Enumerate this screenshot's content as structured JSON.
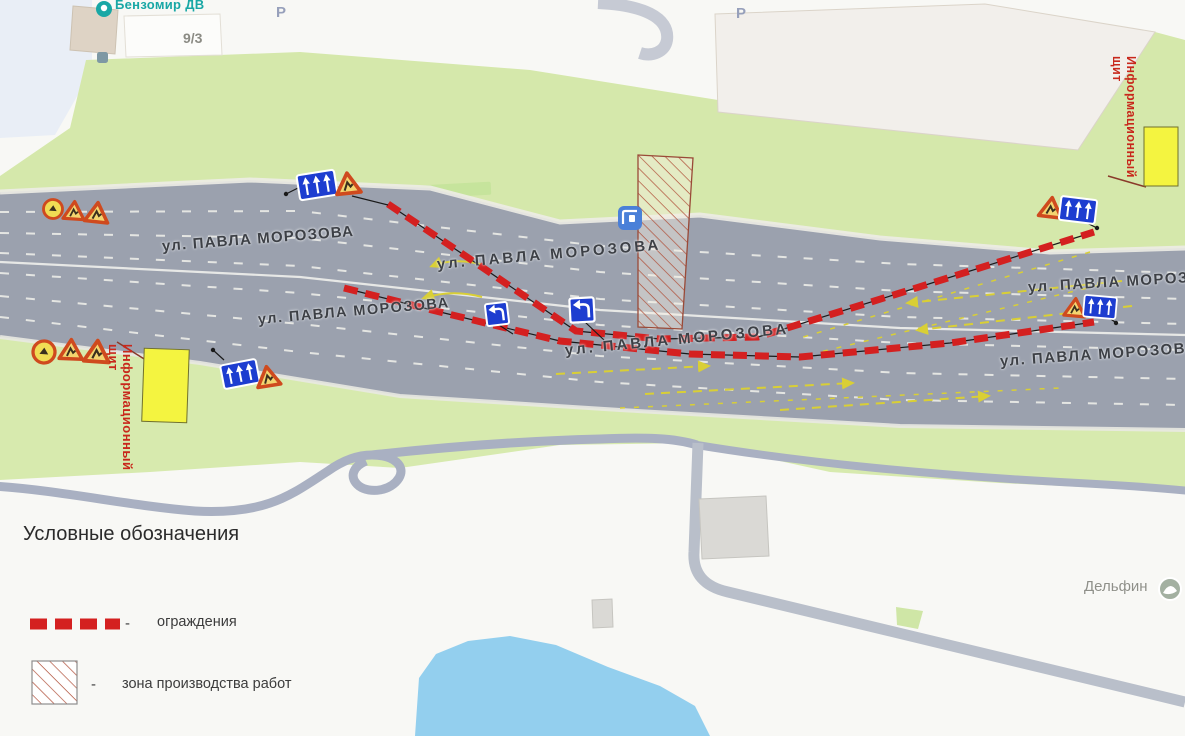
{
  "street": {
    "name": "ул. ПАВЛА МОРОЗОВА"
  },
  "labels": {
    "benzomir": "Бензомир ДВ",
    "building_number": "9/3",
    "parking": "Р",
    "delfin": "Дельфин"
  },
  "info_board": {
    "line1": "Информационный",
    "line2": "щит"
  },
  "legend": {
    "title": "Условные обозначения",
    "items": [
      {
        "symbol": "barrier-dashes",
        "dash": "-",
        "label": "ограждения"
      },
      {
        "symbol": "hatched-area",
        "dash": "-",
        "label": "зона производства работ"
      }
    ]
  },
  "colors": {
    "barrier_red": "#d42020",
    "work_zone_hatch": "#b0503a",
    "info_board_yellow": "#f4f440",
    "arrow_yellow": "#d9cf35",
    "road_gray": "#9ba1ae",
    "green": "#d5e8ab",
    "water_blue": "#93cfee",
    "label_red": "#c8281c"
  },
  "icons": [
    "bus-stop-icon",
    "parking-icon",
    "gas-station-icon",
    "poi-icon",
    "roadworks-triangle-sign",
    "round-restriction-sign",
    "lane-direction-sign",
    "detour-sign"
  ]
}
